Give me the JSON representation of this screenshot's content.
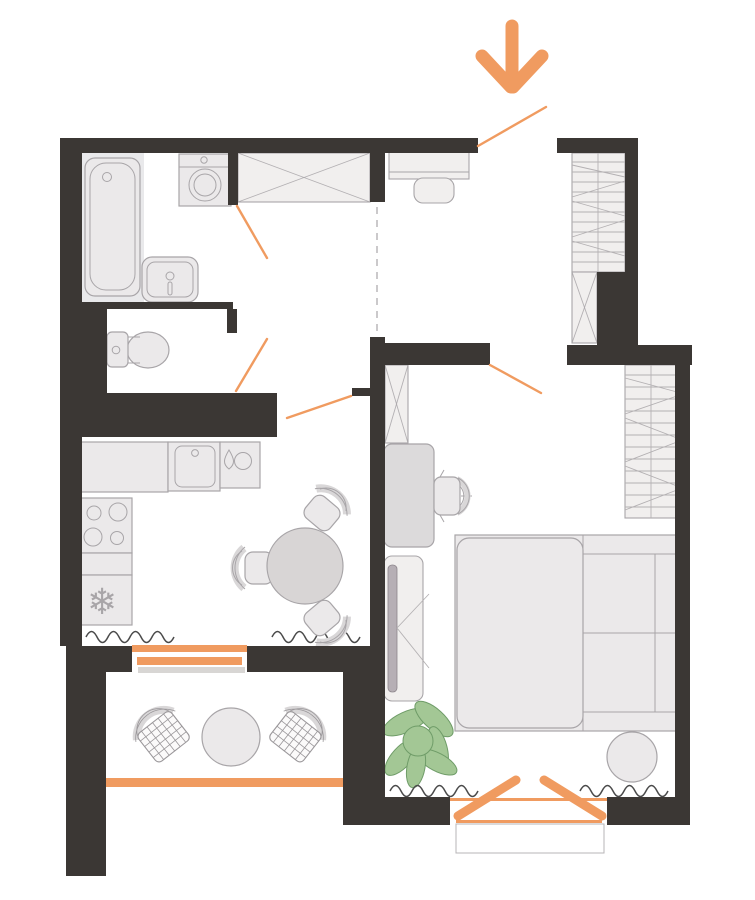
{
  "meta": {
    "title": "apartment-floor-plan"
  },
  "colors": {
    "wall": "#3b3734",
    "accent": "#f09b60",
    "furn": "#ebe9ea",
    "furn_stroke": "#a8a5a8",
    "closet": "#f1efee",
    "floor_gray": "#e9e9eb",
    "table": "#d8d5d5",
    "desk": "#dcdadb",
    "tv": "#b6afb5",
    "seat_band": "#d9d7d8",
    "dash": "#bab7ba",
    "radiator": "#4b4b4b",
    "plant": "#a3c795",
    "plant_stroke": "#6f9c68",
    "grid_stroke": "#9a979a"
  },
  "icons": {
    "snowflake": "❄",
    "entrance_arrow": "down-arrow",
    "water_drop": "drop"
  },
  "rooms": [
    {
      "name": "bathroom",
      "furniture": [
        "bathtub",
        "washing-machine",
        "sink"
      ]
    },
    {
      "name": "wc",
      "furniture": [
        "toilet"
      ]
    },
    {
      "name": "hallway",
      "furniture": [
        "wardrobe-x",
        "entry-bench",
        "shelf-unit",
        "shoe-unit-x"
      ]
    },
    {
      "name": "kitchen",
      "furniture": [
        "counter",
        "kitchen-sink",
        "dishwasher",
        "stove",
        "fridge"
      ]
    },
    {
      "name": "dining",
      "furniture": [
        "round-table",
        "chair",
        "chair",
        "chair"
      ]
    },
    {
      "name": "bedroom",
      "furniture": [
        "wardrobe-x",
        "desk",
        "office-chair",
        "tv-unit",
        "bed",
        "wardrobe-shelves",
        "pouf",
        "plant"
      ]
    },
    {
      "name": "balcony",
      "furniture": [
        "wicker-chair",
        "wicker-chair",
        "small-table"
      ]
    }
  ]
}
